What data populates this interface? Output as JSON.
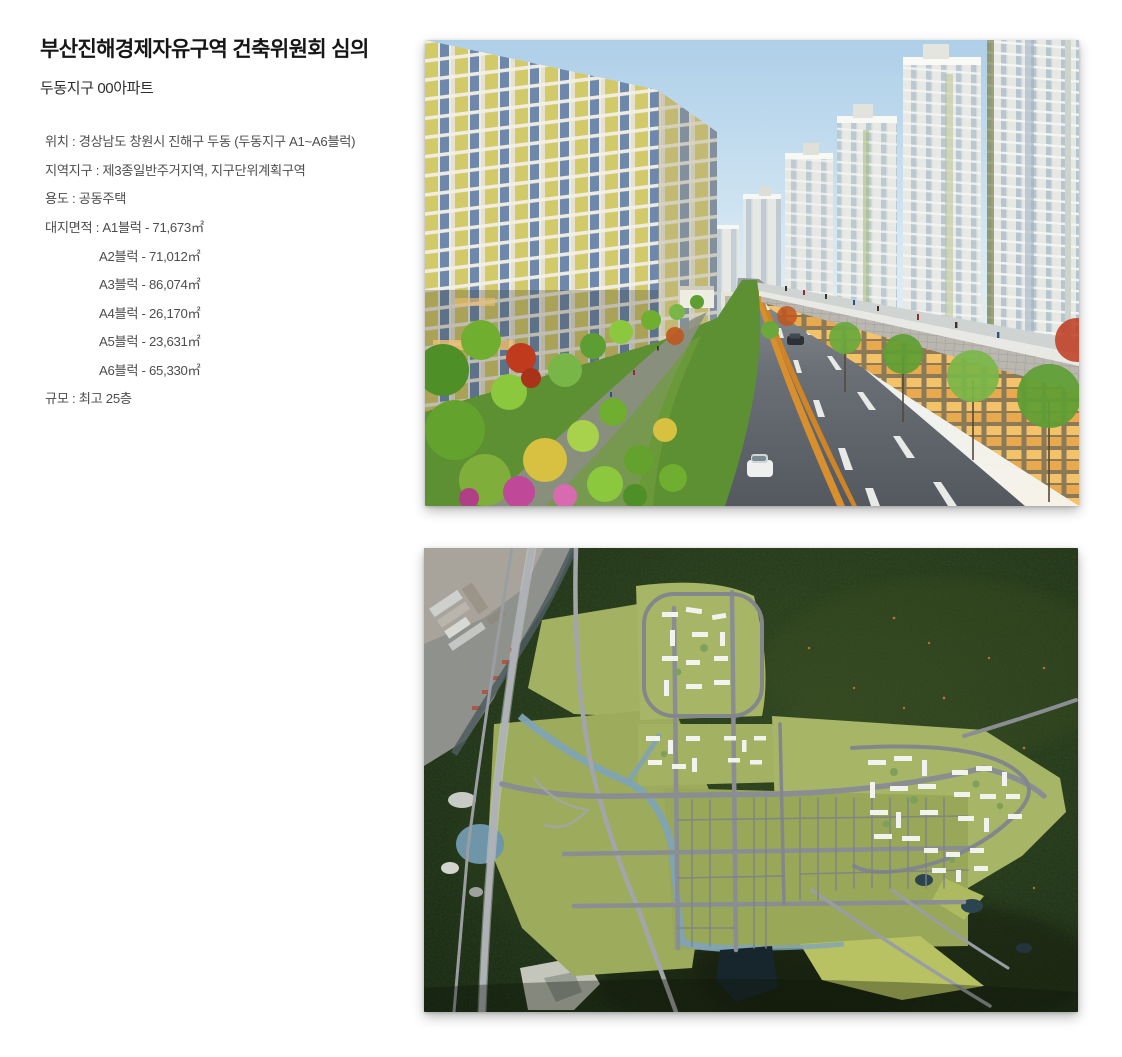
{
  "header": {
    "title": "부산진해경제자유구역 건축위원회 심의",
    "subtitle": "두동지구 00아파트"
  },
  "info": {
    "lines": [
      {
        "text": "위치 : 경상남도 창원시 진해구 두동 (두동지구 A1~A6블럭)",
        "indent": false
      },
      {
        "text": "지역지구 : 제3종일반주거지역, 지구단위계획구역",
        "indent": false
      },
      {
        "text": "용도 : 공동주택",
        "indent": false
      },
      {
        "text": "대지면적 : A1블럭 - 71,673㎡",
        "indent": false
      },
      {
        "text": "A2블럭 - 71,012㎡",
        "indent": true
      },
      {
        "text": "A3블럭 - 86,074㎡",
        "indent": true
      },
      {
        "text": "A4블럭 - 26,170㎡",
        "indent": true
      },
      {
        "text": "A5블럭 - 23,631㎡",
        "indent": true
      },
      {
        "text": "A6블럭 - 65,330㎡",
        "indent": true
      },
      {
        "text": "규모 : 최고 25층",
        "indent": false
      }
    ]
  },
  "figures": {
    "top": {
      "name": "street-level-rendering"
    },
    "bottom": {
      "name": "aerial-masterplan"
    }
  },
  "palette": {
    "page_background": "#ffffff",
    "title_text": "#161616",
    "body_text": "#4d4d4d",
    "render_sky": "#b9d7ea",
    "render_facade_yellow": "#d2ca68",
    "render_tower_white": "#eceae3",
    "render_road": "#62676d",
    "render_centerline_orange": "#d88f2e",
    "render_park_green": "#6fae2f",
    "aerial_forest_dark": "#22301a",
    "aerial_parcel_green": "#a3b162",
    "aerial_road_gray": "#8a8e92",
    "aerial_stream_blue": "#7fa3b5",
    "aerial_buildings_white": "#f2f2ee"
  }
}
